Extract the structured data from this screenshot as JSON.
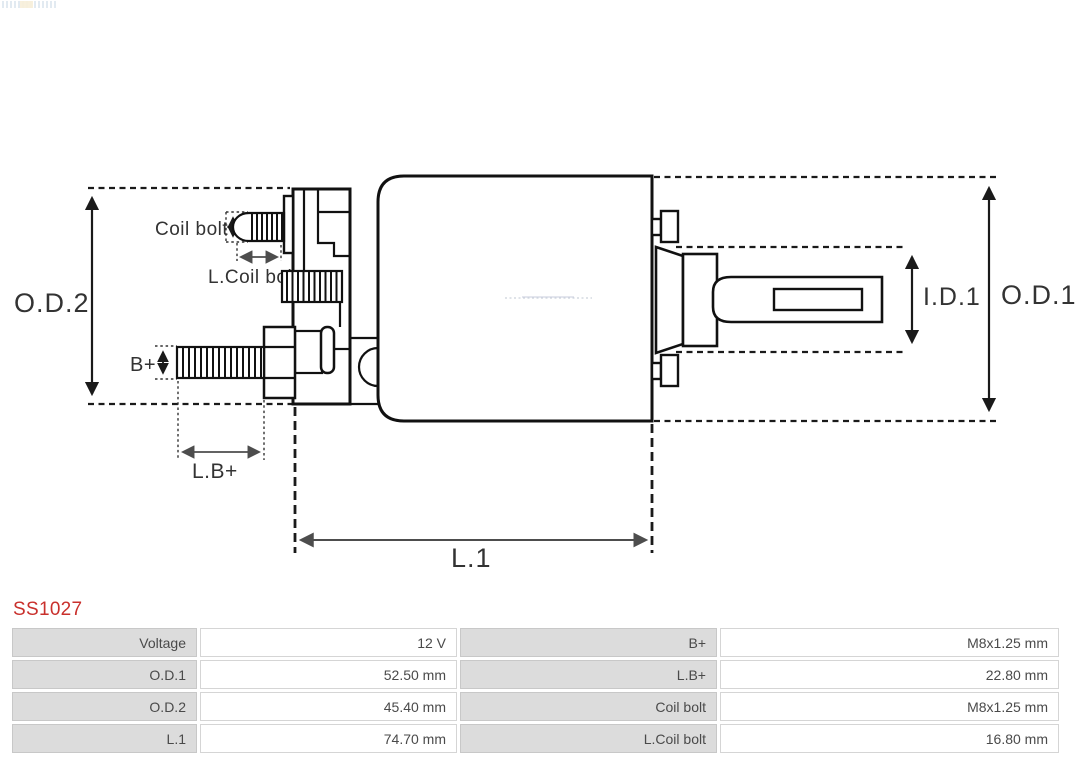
{
  "page": {
    "product_code": "SS1027"
  },
  "diagram": {
    "labels": {
      "od2": "O.D.2",
      "coil_bolt": "Coil bolt",
      "l_coil_bolt": "L.Coil bolt",
      "b_plus": "B+",
      "lb_plus": "L.B+",
      "l1": "L.1",
      "id1": "I.D.1",
      "od1": "O.D.1"
    }
  },
  "spec_table": {
    "rows": [
      {
        "c": [
          "Voltage",
          "12 V",
          "B+",
          "M8x1.25 mm"
        ]
      },
      {
        "c": [
          "O.D.1",
          "52.50 mm",
          "L.B+",
          "22.80 mm"
        ]
      },
      {
        "c": [
          "O.D.2",
          "45.40 mm",
          "Coil bolt",
          "M8x1.25 mm"
        ]
      },
      {
        "c": [
          "L.1",
          "74.70 mm",
          "L.Coil bolt",
          "16.80 mm"
        ]
      }
    ]
  },
  "colors": {
    "product_code_red": "#c9302c",
    "table_label_bg": "#dcdcdc",
    "table_label_border": "#c8c8c8",
    "table_value_border": "#d5d5d5",
    "diagram_line": "#1a1a1a",
    "dimension_gray": "#555555"
  }
}
